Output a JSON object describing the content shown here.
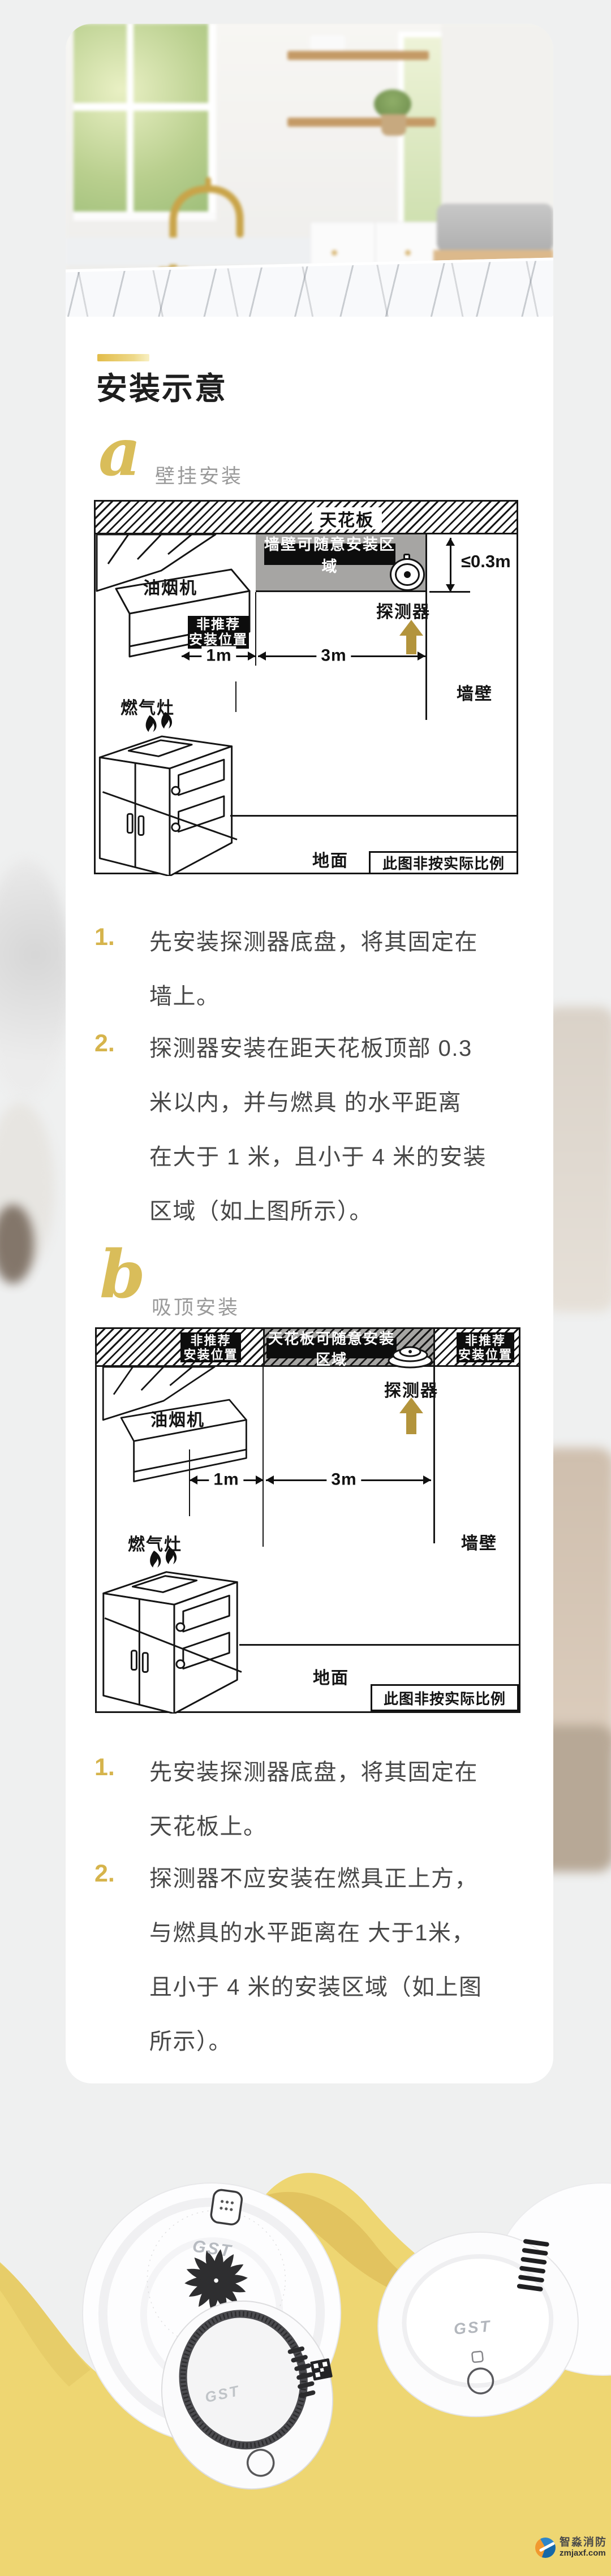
{
  "header": {
    "title": "安装示意"
  },
  "accent": {
    "gold": "#d8b64f",
    "arrow_gold": "#b3943c",
    "banner_yellow": "#eed672",
    "zone_gray": "#a6a5a3"
  },
  "section_a": {
    "letter": "a",
    "label": "壁挂安装",
    "diagram": {
      "ceiling": "天花板",
      "zone": "墙壁可随意安装区域",
      "distance": "≤0.3m",
      "detector": "探测器",
      "hood": "油烟机",
      "nr_line1": "非推荐",
      "nr_line2": "安装位置",
      "dim_1m": "1m",
      "dim_3m": "3m",
      "stove": "燃气灶",
      "wall": "墙壁",
      "floor": "地面",
      "scale_note": "此图非按实际比例"
    },
    "steps": [
      {
        "num": "1.",
        "lines": [
          "先安装探测器底盘，将其固定在",
          "墙上。"
        ]
      },
      {
        "num": "2.",
        "lines": [
          "探测器安装在距天花板顶部 0.3",
          "米以内，并与燃具 的水平距离",
          "在大于 1 米，且小于 4 米的安装",
          "区域（如上图所示）。"
        ]
      }
    ]
  },
  "section_b": {
    "letter": "b",
    "label": "吸顶安装",
    "diagram": {
      "zone": "天花板可随意安装区域",
      "detector": "探测器",
      "hood": "油烟机",
      "nr_line1": "非推荐",
      "nr_line2": "安装位置",
      "dim_1m": "1m",
      "dim_3m": "3m",
      "stove": "燃气灶",
      "wall": "墙壁",
      "floor": "地面",
      "scale_note": "此图非按实际比例"
    },
    "steps": [
      {
        "num": "1.",
        "lines": [
          "先安装探测器底盘，将其固定在",
          "天花板上。"
        ]
      },
      {
        "num": "2.",
        "lines": [
          "探测器不应安装在燃具正上方，",
          "与燃具的水平距离在 大于1米，",
          "且小于 4 米的安装区域（如上图",
          "所示）。"
        ]
      }
    ]
  },
  "products": {
    "brand": "GST"
  },
  "watermark": {
    "name": "智淼消防",
    "site": "zmjaxf.com"
  }
}
